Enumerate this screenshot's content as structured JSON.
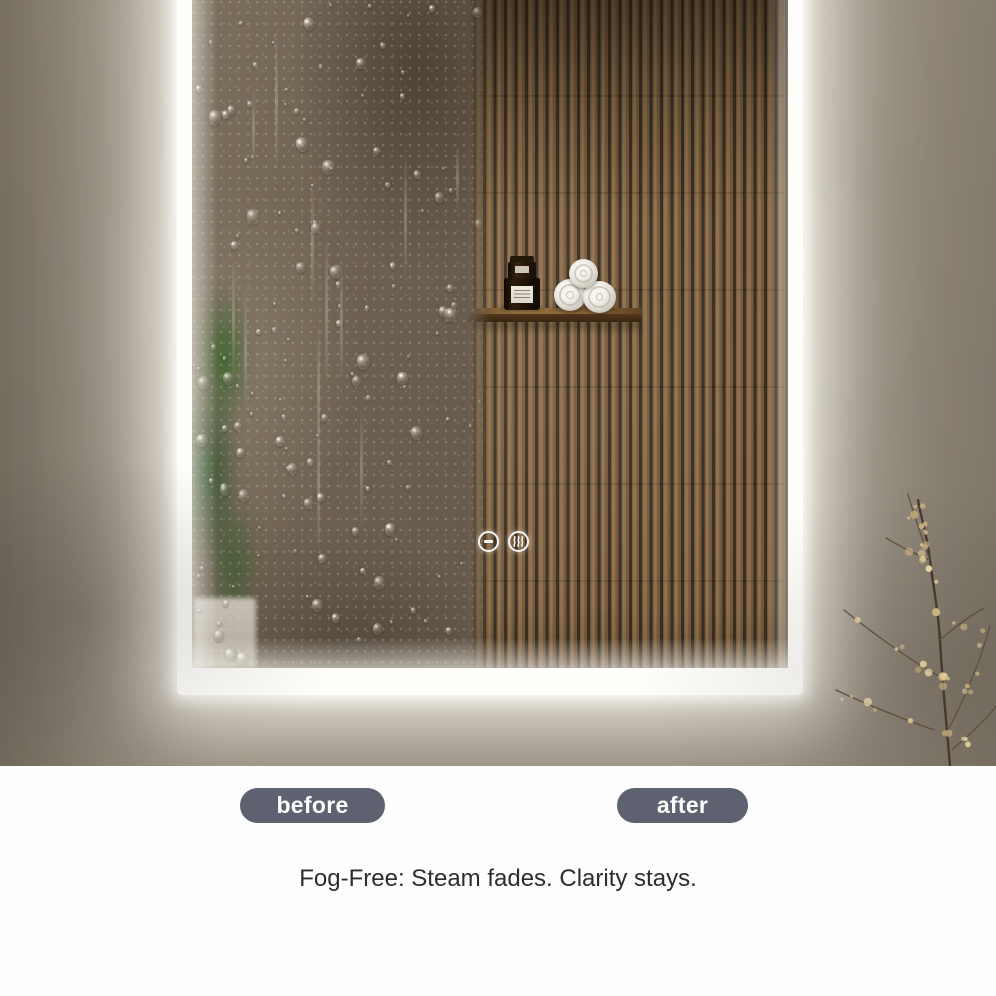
{
  "badges": {
    "before": "before",
    "after": "after"
  },
  "caption": "Fog-Free: Steam fades. Clarity stays.",
  "mirror": {
    "controls": [
      {
        "name": "dimmer-icon",
        "shape": "circle-with-dash"
      },
      {
        "name": "steam-icon",
        "shape": "circle-with-wavy-lines"
      }
    ]
  },
  "colors": {
    "badge_background": "#5e6170",
    "badge_text": "#ffffff",
    "caption_text": "#2d2d2d",
    "wall": "#9d9486",
    "led_glow": "#ffffff",
    "wood_slats": "#8a6d4a",
    "fog_glass": "#6f6252",
    "shelf_wood": "#8a6638",
    "towels": "#e8e5dd",
    "branch_berries": "#d9c493"
  }
}
